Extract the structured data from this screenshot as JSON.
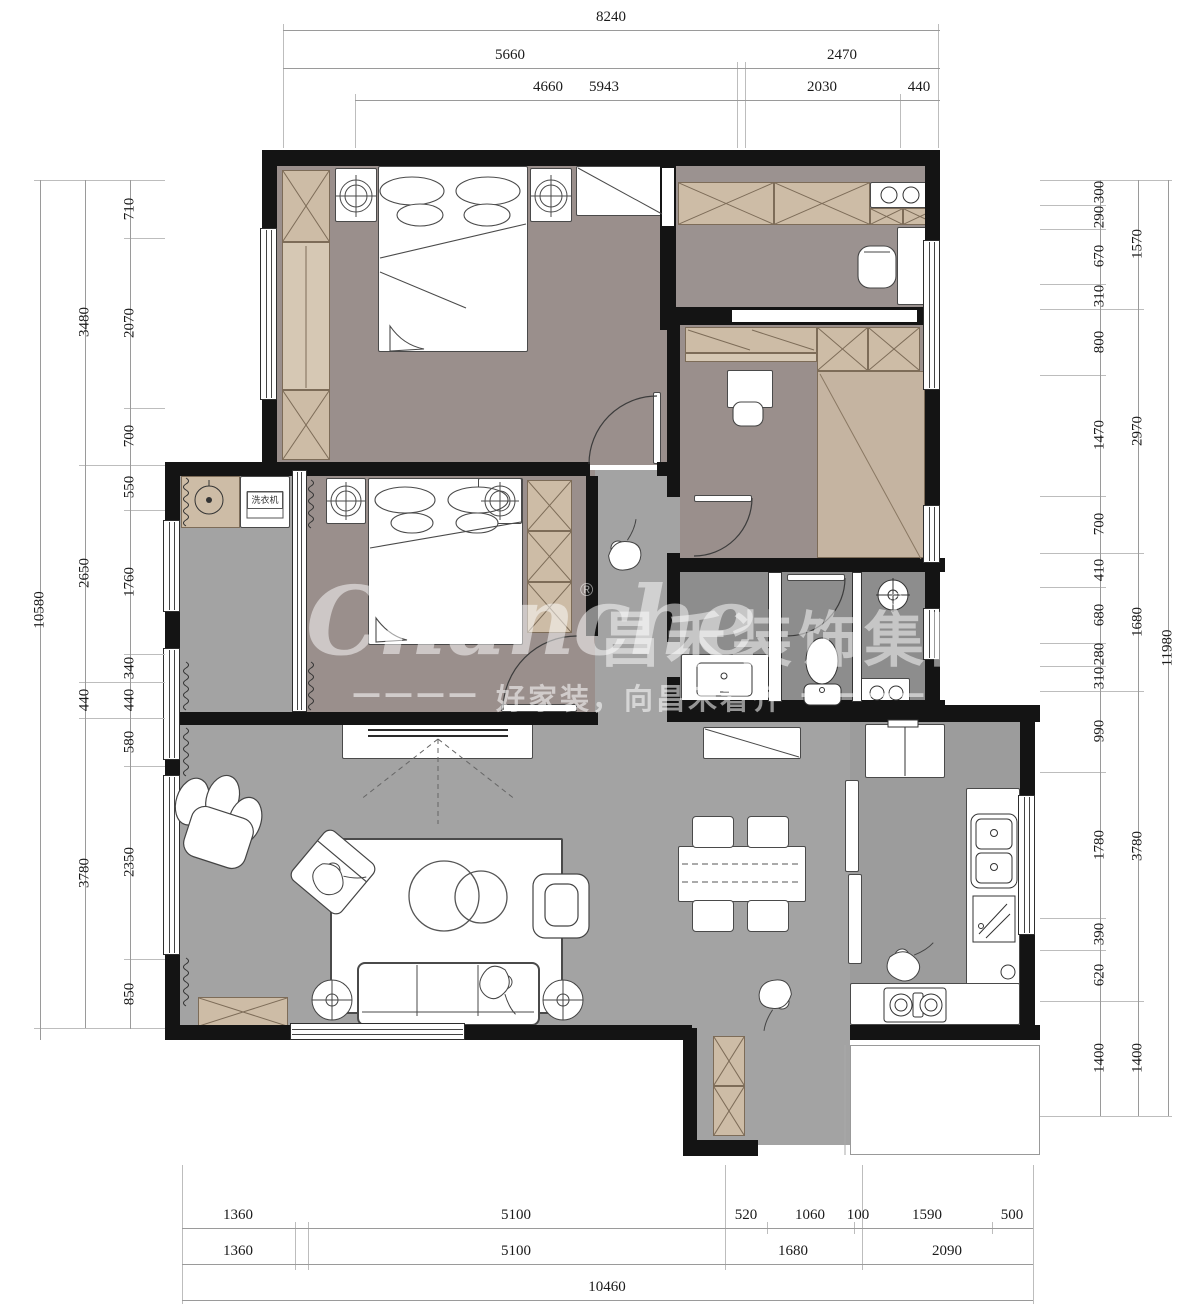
{
  "watermark": {
    "brand_en": "Chanche",
    "registered": "®",
    "brand_cn": "昌禾装饰集团",
    "dash_left": "————",
    "tagline": "好家装，向昌禾看齐",
    "dash_right": "————"
  },
  "labels": {
    "washing_machine": "洗衣机"
  },
  "dims": {
    "top": {
      "r1": [
        "8240"
      ],
      "r2": [
        "5660",
        "2470"
      ],
      "r3": [
        "4660",
        "5943",
        "2030",
        "440"
      ]
    },
    "left": {
      "outer": [
        "10580"
      ],
      "mid": [
        "3480",
        "2650",
        "440",
        "3780"
      ],
      "inner": [
        "710",
        "2070",
        "700",
        "550",
        "1760",
        "340",
        "440",
        "580",
        "2350",
        "850"
      ]
    },
    "right": {
      "inner": [
        "300",
        "290",
        "670",
        "310",
        "800",
        "1470",
        "700",
        "410",
        "680",
        "280",
        "310",
        "990",
        "1780",
        "390",
        "620",
        "1400"
      ],
      "mid": [
        "1570",
        "2970",
        "1680",
        "3780",
        "1400"
      ],
      "outer": [
        "11980"
      ]
    },
    "bottom": {
      "r1": [
        "1360",
        "5100",
        "520",
        "1060",
        "100",
        "1590",
        "500"
      ],
      "r2": [
        "1360",
        "5100",
        "1680",
        "2090"
      ],
      "r3": [
        "10460"
      ]
    }
  },
  "colors": {
    "wall": "#141414",
    "bedroom_floor": "#9a8f8c",
    "hall_floor": "#a3a3a3",
    "bath_floor": "#8d8d8d",
    "kitchen_floor": "#9c9c9c",
    "cabinet_tan": "#cdbca6",
    "tatami_tan": "#c5b4a1",
    "dim_line": "#9a9a9a",
    "dim_text": "#1a1a1a",
    "watermark": "rgba(255,255,255,0.5)"
  }
}
